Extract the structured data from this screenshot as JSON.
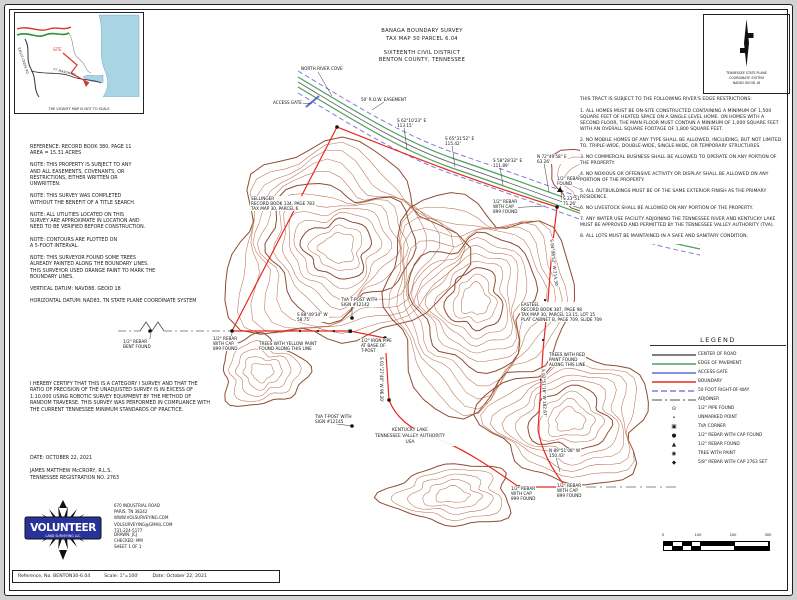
{
  "sheet": {
    "title1": "BANAGA BOUNDARY SURVEY",
    "title2": "TAX MAP 30 PARCEL 6.04",
    "title3": "SIXTEENTH CIVIL DISTRICT",
    "title4": "BENTON COUNTY, TENNESSEE"
  },
  "vicinity": {
    "caption": "THE VICINITY MAP IS NOT TO SCALE",
    "site_label": "SITE",
    "road1": "FT. MASON RD",
    "road2": "EAGLE CREEK RD"
  },
  "north_arrow": {
    "line1": "TENNESSEE STATE PLANE",
    "line2": "COORDINATE SYSTEM",
    "line3": "NAD83  GEOID 18"
  },
  "notes": [
    "REFERENCE: RECORD BOOK 380, PAGE 11\nAREA = 15.31 ACRES",
    "NOTE: THIS PROPERTY IS SUBJECT TO ANY\nAND ALL EASEMENTS, COVENANTS, OR\nRESTRICTIONS, EITHER WRITTEN OR\nUNWRITTEN.",
    "NOTE: THIS SURVEY WAS COMPLETED\nWITHOUT THE BENEFIT OF A TITLE SEARCH.",
    "NOTE: ALL UTILITIES LOCATED ON THIS\nSURVEY ARE APPROXIMATE IN LOCATION AND\nNEED TO BE VERIFIED BEFORE CONSTRUCTION.",
    "NOTE: CONTOURS ARE PLOTTED ON\nA 5-FOOT INTERVAL.",
    "NOTE: THIS SURVEYOR FOUND SOME TREES\nALREADY PAINTED ALONG THE BOUNDARY LINES.\nTHIS SURVEYOR USED ORANGE PAINT TO MARK THE\nBOUNDARY LINES.",
    "VERTICAL DATUM: NAVD88, GEOID 18",
    "HORIZONTAL DATUM: NAD83, TN STATE PLANE COORDINATE SYSTEM"
  ],
  "restrictions": {
    "intro": "THIS TRACT IS SUBJECT TO THE FOLLOWING RIVER'S EDGE RESTRICTIONS:",
    "items": [
      "1. ALL HOMES MUST BE ON-SITE CONSTRUCTED CONTAINING A MINIMUM OF 1,500 SQUARE FEET OF HEATED SPACE ON A SINGLE LEVEL HOME. ON HOMES WITH A SECOND FLOOR, THE MAIN FLOOR MUST CONTAIN A MINIMUM OF 1,000 SQUARE FEET WITH AN OVERALL SQUARE FOOTAGE OF 1,800 SQUARE FEET.",
      "2. NO MOBILE HOMES OF ANY TYPE SHALL BE ALLOWED, INCLUDING, BUT NOT LIMITED TO, TRIPLE-WIDE, DOUBLE-WIDE, SINGLE-WIDE, OR TEMPORARY STRUCTURES.",
      "3. NO COMMERCIAL BUSINESS SHALL BE ALLOWED TO OPERATE ON ANY PORTION OF THE PROPERTY.",
      "4. NO NOXIOUS OR OFFENSIVE ACTIVITY OR DISPLAY SHALL BE ALLOWED ON ANY PORTION OF THE PROPERTY.",
      "5. ALL OUTBUILDINGS MUST BE OF THE SAME EXTERIOR FINISH AS THE PRIMARY RESIDENCE.",
      "6. NO LIVESTOCK SHALL BE ALLOWED ON ANY PORTION OF THE PROPERTY.",
      "7. ANY WATER USE FACILITY ADJOINING THE TENNESSEE RIVER AND KENTUCKY LAKE MUST BE APPROVED AND PERMITTED BY THE TENNESSEE VALLEY AUTHORITY (TVA).",
      "8. ALL LOTS MUST BE MAINTAINED IN A SAFE AND SANITARY CONDITION."
    ]
  },
  "legend": {
    "title": "LEGEND",
    "lines": [
      {
        "label": "CENTER OF ROAD",
        "color": "#555555",
        "dash": ""
      },
      {
        "label": "EDGE OF PAVEMENT",
        "color": "#4fa05e",
        "dash": ""
      },
      {
        "label": "ACCESS GATE",
        "color": "#5b6ed6",
        "dash": ""
      },
      {
        "label": "BOUNDARY",
        "color": "#e8281e",
        "dash": ""
      },
      {
        "label": "50 FOOT RIGHT-OF-WAY",
        "color": "#8878d8",
        "dash": "6,3"
      },
      {
        "label": "ADJOINER",
        "color": "#8a8a8a",
        "dash": "10,3,2,3"
      }
    ],
    "symbols": [
      {
        "glyph": "⊙",
        "label": "1/2\" PIPE FOUND"
      },
      {
        "glyph": "•",
        "label": "UNMARKED POINT"
      },
      {
        "glyph": "▣",
        "label": "TVA CORNER"
      },
      {
        "glyph": "●",
        "label": "1/2\" REBAR WITH CAP FOUND"
      },
      {
        "glyph": "▲",
        "label": "1/2\" REBAR FOUND"
      },
      {
        "glyph": "◉",
        "label": "TREE WITH PAINT"
      },
      {
        "glyph": "◆",
        "label": "5/8\" REBAR WITH CAP 2763 SET"
      }
    ]
  },
  "certification": {
    "text": "I HEREBY CERTIFY THAT THIS IS A CATEGORY I SURVEY AND THAT THE RATIO OF PRECISION OF THE UNADJUSTED SURVEY IS IN EXCESS OF 1:10,000 USING ROBOTIC SURVEY EQUIPMENT BY THE METHOD OF RANDOM TRAVERSE. THIS SURVEY WAS PERFORMED IN COMPLIANCE WITH THE CURRENT TENNESSEE MINIMUM STANDARDS OF PRACTICE.",
    "date": "DATE: OCTOBER 22, 2021",
    "surveyor": "JAMES MATTHEW McCRORY, R.L.S.",
    "registration": "TENNESSEE REGISTRATION NO. 2763"
  },
  "firm": {
    "name": "VOLUNTEER",
    "tagline": "LAND SURVEYING LLC",
    "address_lines": [
      "670 INDUSTRIAL ROAD",
      "PARIS, TN 38242",
      "WWW.VOLSURVEYING.COM",
      "VOLSURVEYING@GMAIL.COM",
      "731-224-5177"
    ],
    "meta_lines": [
      "DRAWN: JCJ",
      "CHECKED: MM",
      "SHEET 1 OF 1"
    ]
  },
  "footer": {
    "reference": "Reference, No. BENTON30-6.04",
    "scale": "Scale: 1\"=100'",
    "date": "Date: October 22, 2021"
  },
  "scalebar": {
    "t0": "0",
    "t1": "100",
    "t2": "200",
    "t3": "300"
  },
  "map": {
    "lake": {
      "line1": "KENTUCKY LAKE",
      "line2": "TENNESSEE VALLEY AUTHORITY",
      "line3": "USA"
    },
    "colors": {
      "contour": "#b86a48",
      "contour_index": "#8a4226",
      "boundary": "#e8281e",
      "pavement": "#4fa05e",
      "row": "#8878d8",
      "centerline": "#555555",
      "adjoiner": "#8a8a8a",
      "water": "#a8d4e4"
    },
    "labels": [
      {
        "x": 300,
        "y": 66,
        "lines": [
          "NORTH RIVER COVE"
        ]
      },
      {
        "x": 272,
        "y": 100,
        "lines": [
          "ACCESS GATE"
        ]
      },
      {
        "x": 360,
        "y": 97,
        "lines": [
          "50' R.O.W. EASEMENT"
        ]
      },
      {
        "x": 396,
        "y": 118,
        "lines": [
          "S 62°10'23\" E",
          "113.15'"
        ]
      },
      {
        "x": 444,
        "y": 136,
        "lines": [
          "S 65°31'52\" E",
          "115.42'"
        ]
      },
      {
        "x": 492,
        "y": 158,
        "lines": [
          "S 58°28'32\" E",
          "111.89'"
        ]
      },
      {
        "x": 536,
        "y": 154,
        "lines": [
          "N 72°49'58\" E",
          "63.26'"
        ]
      },
      {
        "x": 556,
        "y": 176,
        "lines": [
          "1/2\" REBAR",
          "FOUND"
        ]
      },
      {
        "x": 562,
        "y": 196,
        "lines": [
          "S 23°51'17\" E",
          "71.26'"
        ]
      },
      {
        "x": 492,
        "y": 199,
        "lines": [
          "1/2\" REBAR",
          "WITH CAP",
          "899 FOUND"
        ]
      },
      {
        "x": 250,
        "y": 196,
        "lines": [
          "SELLINGER",
          "RECORD BOOK 134, PAGE 783",
          "TAX MAP 30, PARCEL 6"
        ]
      },
      {
        "x": 520,
        "y": 302,
        "lines": [
          "EASTEEL",
          "RECORD BOOK 387, PAGE 98",
          "TAX MAP 30, PARCEL 13.15, LOT 15",
          "PLAT CABINET B, PAGE 709, SLIDE 709"
        ]
      },
      {
        "x": 548,
        "y": 352,
        "lines": [
          "TREES WITH RED",
          "PAINT FOUND",
          "ALONG THIS LINE"
        ]
      },
      {
        "x": 258,
        "y": 341,
        "lines": [
          "TREES WITH YELLOW PAINT",
          "FOUND ALONG THIS LINE"
        ]
      },
      {
        "x": 340,
        "y": 297,
        "lines": [
          "TVA T-POST WITH",
          "SIGN #12142"
        ]
      },
      {
        "x": 296,
        "y": 312,
        "lines": [
          "S 88°49'34\" W",
          "58.75'"
        ]
      },
      {
        "x": 360,
        "y": 338,
        "lines": [
          "1/2\" IRON PIPE",
          "AT BASE OF",
          "T-POST"
        ]
      },
      {
        "x": 122,
        "y": 339,
        "lines": [
          "1/2\" REBAR",
          "BENT FOUND"
        ]
      },
      {
        "x": 212,
        "y": 336,
        "lines": [
          "1/2\" REBAR",
          "WITH CAP",
          "899 FOUND"
        ]
      },
      {
        "x": 314,
        "y": 414,
        "lines": [
          "TVA T-POST WITH",
          "SIGN #12145"
        ]
      },
      {
        "x": 548,
        "y": 448,
        "lines": [
          "N 89°51'08\" W",
          "150.43'"
        ]
      },
      {
        "x": 510,
        "y": 486,
        "lines": [
          "1/2\" REBAR",
          "WITH CAP",
          "899 FOUND"
        ]
      },
      {
        "x": 556,
        "y": 483,
        "lines": [
          "1/2\" REBAR",
          "WITH CAP",
          "899 FOUND"
        ]
      },
      {
        "x": 554,
        "y": 238,
        "rot": 84,
        "lines": [
          "S 04°08'52\" W  214.30'"
        ]
      },
      {
        "x": 546,
        "y": 368,
        "rot": 88,
        "lines": [
          "S 02°51'16\" W  182.67'"
        ]
      },
      {
        "x": 384,
        "y": 356,
        "rot": 90,
        "lines": [
          "S 01°27'40\" W  96.20'"
        ]
      }
    ]
  }
}
